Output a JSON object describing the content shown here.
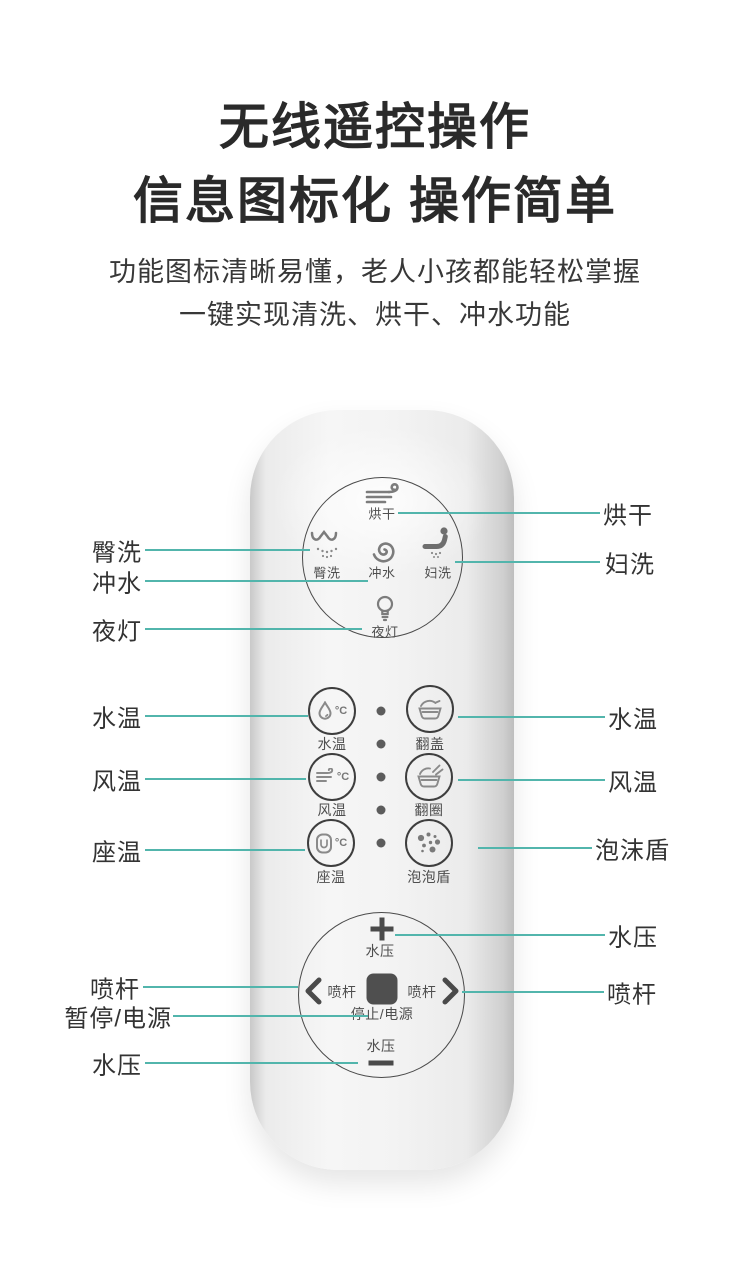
{
  "header": {
    "title_line1": "无线遥控操作",
    "title_line2": "信息图标化 操作简单",
    "subtitle_line1": "功能图标清晰易懂，老人小孩都能轻松掌握",
    "subtitle_line2": "一键实现清洗、烘干、冲水功能"
  },
  "remote": {
    "top_cluster": {
      "dry": {
        "label": "烘干",
        "icon": "wind-icon"
      },
      "hip_wash": {
        "label": "臀洗",
        "icon": "hip-spray-icon"
      },
      "flush": {
        "label": "冲水",
        "icon": "spiral-icon"
      },
      "lady_wash": {
        "label": "妇洗",
        "icon": "seated-person-spray-icon"
      },
      "night_light": {
        "label": "夜灯",
        "icon": "bulb-icon"
      }
    },
    "middle_buttons": {
      "water_temp": {
        "label": "水温",
        "unit": "°C",
        "icon": "water-drop-icon"
      },
      "wind_temp": {
        "label": "风温",
        "unit": "°C",
        "icon": "wind-small-icon"
      },
      "seat_temp": {
        "label": "座温",
        "unit": "°C",
        "icon": "seat-icon"
      },
      "flip_lid": {
        "label": "翻盖",
        "icon": "toilet-lid-icon"
      },
      "flip_ring": {
        "label": "翻圈",
        "icon": "toilet-ring-icon"
      },
      "bubble_shield": {
        "label": "泡泡盾",
        "icon": "bubbles-icon"
      }
    },
    "bottom_cluster": {
      "pressure_up_label": "水压",
      "plus_symbol": "+",
      "spray_left_label": "喷杆",
      "stop_label": "停止/电源",
      "spray_right_label": "喷杆",
      "pressure_down_label": "水压",
      "minus_symbol": "−"
    }
  },
  "callouts": {
    "left": [
      {
        "label": "臀洗"
      },
      {
        "label": "冲水"
      },
      {
        "label": "夜灯"
      },
      {
        "label": "水温"
      },
      {
        "label": "风温"
      },
      {
        "label": "座温"
      },
      {
        "label": "喷杆"
      },
      {
        "label": "暂停/电源"
      },
      {
        "label": "水压"
      }
    ],
    "right": [
      {
        "label": "烘干"
      },
      {
        "label": "妇洗"
      },
      {
        "label": "水温"
      },
      {
        "label": "风温"
      },
      {
        "label": "泡沫盾"
      },
      {
        "label": "水压"
      },
      {
        "label": "喷杆"
      }
    ]
  },
  "colors": {
    "accent_line": "#52b5ac",
    "title_text": "#2a2a2a",
    "callout_text": "#333333",
    "remote_icon": "#7c7c7c",
    "remote_outline": "#4a4a4a"
  }
}
